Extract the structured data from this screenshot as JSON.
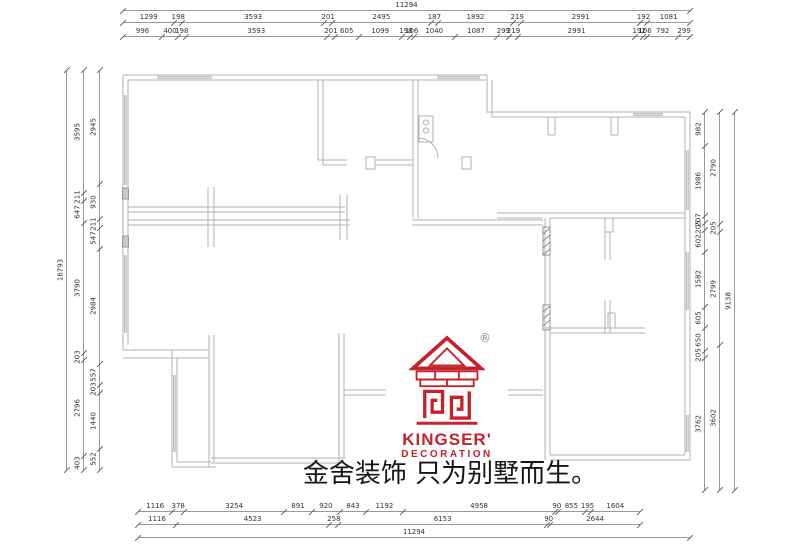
{
  "meta": {
    "background": "#ffffff",
    "wall_color": "#b2b2b2",
    "dim_line_color": "#9a9a9a",
    "dim_text_color": "#333333",
    "accent_red": "#c4232b"
  },
  "branding": {
    "logo_name": "KINGSER'",
    "logo_sub": "DECORATION",
    "registered_mark": "®",
    "slogan": "金舍装饰 只为别墅而生。",
    "emblem_icon": "house-emblem-icon",
    "logo_color": "#c4232b"
  },
  "dimensions": {
    "top": {
      "overall": [
        "11294"
      ],
      "row1": [
        "1299",
        "198",
        "3593",
        "201",
        "2495",
        "187",
        "1892",
        "219",
        "2991",
        "192",
        "1081"
      ],
      "row2": [
        "996",
        "400",
        "198",
        "3593",
        "201",
        "605",
        "1099",
        "198",
        "106",
        "1040",
        "1087",
        "299",
        "219",
        "2991",
        "192",
        "106",
        "792",
        "299"
      ]
    },
    "bottom": {
      "row1": [
        "1116",
        "378",
        "3254",
        "891",
        "920",
        "843",
        "1192",
        "4958",
        "90",
        "855",
        "195",
        "1604"
      ],
      "row2": [
        "1116",
        "4523",
        "258",
        "6153",
        "90",
        "2644"
      ],
      "overall": [
        "11294"
      ]
    },
    "left": {
      "overall": [
        "16793"
      ],
      "chain_outer": [
        "3595",
        "211",
        "647",
        "3790",
        "203",
        "2796",
        "403"
      ],
      "chain_inner": [
        "2945",
        "930",
        "211",
        "547",
        "2984",
        "557",
        "203",
        "1440",
        "552"
      ]
    },
    "right": {
      "chain_inner": [
        "982",
        "1986",
        "207",
        "205",
        "602",
        "1582",
        "605",
        "650",
        "205",
        "3762"
      ],
      "chain_outer": [
        "2790",
        "205",
        "2799",
        "3602"
      ],
      "overall": [
        "9138"
      ]
    }
  }
}
